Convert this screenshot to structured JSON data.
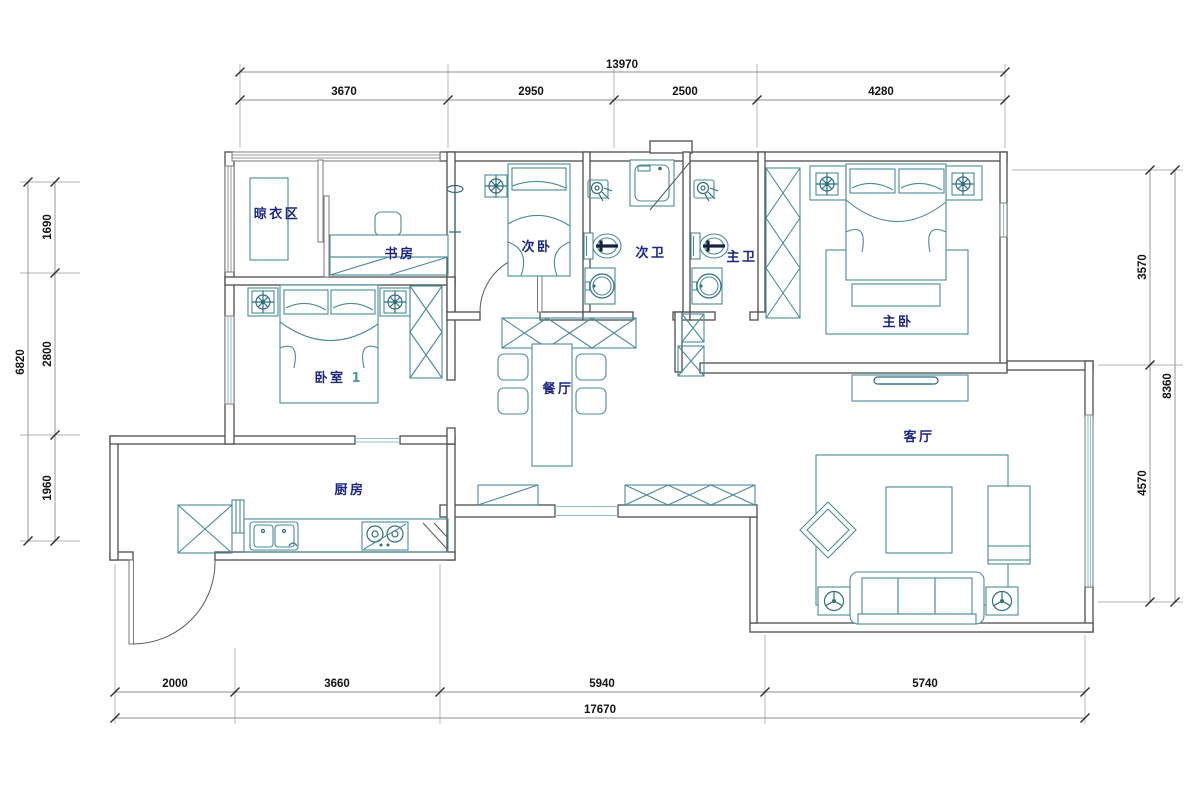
{
  "drawing": {
    "type": "apartment-floor-plan",
    "units": "mm"
  },
  "rooms": {
    "drying": {
      "label": "晾衣区"
    },
    "study": {
      "label": "书房"
    },
    "bedroom2": {
      "label": "次卧"
    },
    "bath2": {
      "label": "次卫"
    },
    "bath_master": {
      "label": "主卫"
    },
    "master": {
      "label": "主卧"
    },
    "bedroom1": {
      "label": "卧室",
      "number": "1"
    },
    "dining": {
      "label": "餐厅"
    },
    "kitchen": {
      "label": "厨房"
    },
    "living": {
      "label": "客厅"
    }
  },
  "dimensions": {
    "top": {
      "total": "13970",
      "segments": [
        "3670",
        "2950",
        "2500",
        "4280"
      ]
    },
    "left": {
      "total": "6820",
      "segments": [
        "1690",
        "2800",
        "1960"
      ]
    },
    "right": {
      "total": "8360",
      "segments": [
        "3570",
        "4570"
      ]
    },
    "bottom": {
      "total": "17670",
      "segments": [
        "2000",
        "3660",
        "5940",
        "5740"
      ]
    }
  },
  "colors": {
    "wall": "#4f4f4f",
    "furniture": "#4a8b9c",
    "furniture_dark": "#2e6f82",
    "room_label": "#1b2680",
    "accent": "#4a9aac",
    "window": "#8fc1cc",
    "dimension_line": "#8c8c8c",
    "dimension_text": "#141414",
    "background": "#ffffff"
  }
}
